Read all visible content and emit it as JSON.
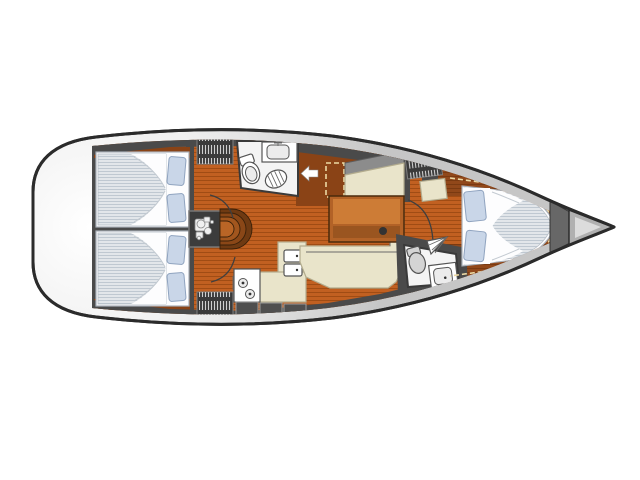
{
  "page": {
    "title": "Sailboat interior floor plan (top view, bow to the right)"
  },
  "colors": {
    "background": "#ffffff",
    "hull_outline": "#2b2b2b",
    "hull_edge": "#c6c6c6",
    "deck_wall": "#4a4a4a",
    "wood_floor": "#c16021",
    "wood_floor_line": "#a04c14",
    "wood_platform": "#91481a",
    "wood_platform_line": "#7a3a11",
    "wood_rich": "#8a4316",
    "trim_dash": "#ecd9a4",
    "room_floor": "#f4f4f4",
    "fixture_fill": "#ffffff",
    "fixture_line": "#555555",
    "bedding": "#fdfdfe",
    "bedding_edge": "#a9b0b8",
    "mattress_base": "#e2e6ea",
    "mattress_stripe": "#bfc8d1",
    "pillow": "#c9d6e8",
    "pillow_edge": "#8fa3bf",
    "upholstery": "#e9e4ca",
    "upholstery_edge": "#b3ac8e",
    "settee_back": "#8c8c8c",
    "table_wood": "#b26227",
    "table_wood_light": "#cd7c36",
    "table_wood_dark": "#9a5520",
    "engine_box": "#3c3c3c",
    "engine_glyph": "#f0f0f0",
    "locker": "#3a3a3a",
    "locker_stripe": "#cfcfcf",
    "cabinet_panel": "#4f4f4f",
    "cabinet_edge": "#9a9a9a",
    "bow_locker_outer": "#b0b0b0",
    "bow_locker_inner": "#dcdcdc"
  },
  "rooms": {
    "hull": "yacht hull, bow pointing right",
    "transom": "stern swim platform",
    "aft_cabin_port": "aft double cabin (top)",
    "aft_cabin_starboard": "aft double cabin (bottom)",
    "aft_head": "aft head with toilet, sink and shower",
    "saloon": "saloon with settees and table",
    "galley": "L-shaped galley with stove and double sink",
    "companionway": "companionway steps over engine compartment",
    "forward_head": "forward head with toilet and sink",
    "forward_cabin": "forward cabin with island double berth",
    "anchor_locker": "bow anchor locker"
  },
  "fixtures": {
    "berth_icon": "double berth with duvet and pillows",
    "pillow_icon": "pillow",
    "toilet_icon": "toilet",
    "sink_icon": "washbasin",
    "shower_icon": "shower grate",
    "stove_icon": "two-burner stove",
    "galley_sink_icon": "double galley sink",
    "table_icon": "saloon table",
    "settee_icon": "upholstered settee",
    "hanging_locker_icon": "hanging locker",
    "engine_icon": "engine",
    "steps_icon": "companionway steps",
    "door_arc_icon": "door swing arc",
    "entry_arrow_icon": "entry direction arrow",
    "anchor_locker_icon": "anchor locker"
  }
}
